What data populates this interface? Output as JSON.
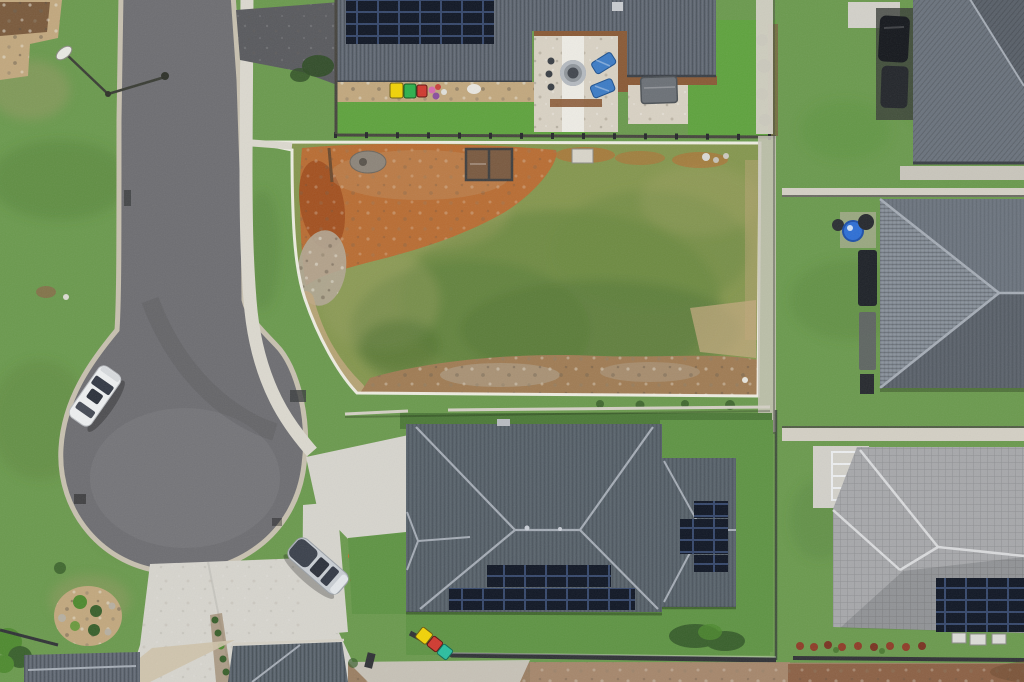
{
  "scene": {
    "label": "Aerial drone view of a suburban cul-de-sac street, a fenced vacant lot and surrounding houses with rooftop solar panels"
  },
  "objects": {
    "street": "asphalt residential street",
    "cul_de_sac": "cul-de-sac turning circle",
    "street_lamp": "street lamp over road",
    "white_car": "white car parked on cul-de-sac kerb",
    "silver_car": "silver car parked on side path",
    "vacant_lot": "vacant lot with orange dirt and patchy grass",
    "lot_boundary": "white boundary line around vacant lot",
    "top_house": "house with corrugated roof, solar array and gravel courtyard",
    "main_house": "large hip-roof house with solar panels",
    "ne_house": "neighbouring house at top right",
    "east_house": "neighbouring hip-roof house at middle right",
    "se_house": "tiled-roof house at bottom right with solar panels",
    "fire_pit": "round fire pit on gravel patio",
    "loungers": "two blue sun loungers",
    "shed": "small grey garden shed",
    "barrel": "blue barrel beside house wall",
    "bins_top": "yellow, green and red wheelie bins",
    "bins_bottom": "yellow, red and teal wheelie bins",
    "driveways": "concrete driveways and footpaths",
    "garden_bed": "rock-edged garden bed",
    "solar": "rooftop solar panel arrays"
  },
  "colors": {
    "grass_base": "#6b9a4e",
    "grass_bright": "#5fa33e",
    "grass_mid": "#639a47",
    "grass_low": "#5f9444",
    "grass_dark": "#4f7a36",
    "grass_dry": "#a89a6d",
    "lot_base": "#85974f",
    "lot_green": "#6b8a41",
    "lot_dark": "#54763a",
    "lot_dry": "#a3a368",
    "dirt_orange": "#bc6a32",
    "dirt_rust": "#9e4a1c",
    "dirt_tan": "#c2a87e",
    "rubble_gray": "#b2a795",
    "dirt_strip": "#a07c54",
    "dirt_ground": "#9b7f63",
    "dirt_pink": "#ab8a70",
    "dirt_red": "#8a5c40",
    "road": "#6e6e72",
    "road_dark": "#595a5e",
    "curb": "#c8c1b0",
    "footpath": "#dcd9cf",
    "concrete": "#d7d5ce",
    "concrete_dim": "#c9c6bc",
    "roof_dark": "#5d6570",
    "roof_slate": "#566069",
    "roof_hip_light": "#828a94",
    "roof_hip_mid": "#6b737d",
    "roof_hip_dark": "#596069",
    "roof_tile": "#a7a8ab",
    "ridge_light": "#a6adb6",
    "ridge_white": "#dadbdd",
    "solar": "#101725",
    "deck": "#8a5a36",
    "gravel": "#d9d2c4",
    "path_white": "#eeece5",
    "firepit_ring": "#b5bac0",
    "firepit_core": "#42474f",
    "lounger": "#3d7cc6",
    "barrel": "#2e6fd5",
    "shed": "#6c7177",
    "bin_yellow": "#f2d307",
    "bin_green": "#2eb04d",
    "bin_red": "#d03a30",
    "bin_teal": "#2bbfa0",
    "toy_pink": "#d66bb0",
    "toy_purple": "#8a4f9e",
    "car_white": "#eef0f1",
    "car_silver": "#c9ced3",
    "car_glass": "#333945",
    "car_dark": "#15181d",
    "fence_dark": "#303236",
    "fence_light": "#d4d0c5",
    "white_line": "#f3f1e9",
    "plant_dark": "#39602c",
    "plant_bright": "#4e8a2f",
    "plant_red": "#8f3c28",
    "flower_orange": "#c96a2a",
    "lamp_white": "#e9e9e3",
    "pad": "#d3d1ca",
    "box_white": "#dcdcd8",
    "equip_dark": "#1e2228",
    "drain": "#3c3e40"
  }
}
